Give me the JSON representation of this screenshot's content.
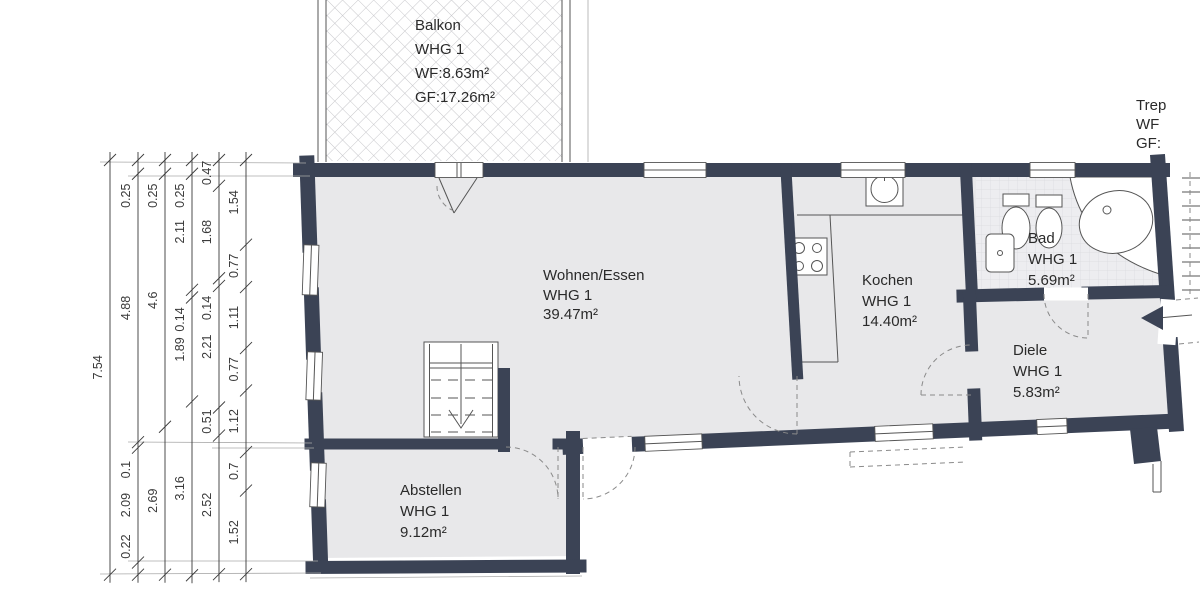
{
  "plan": {
    "balcony": {
      "name": "Balkon",
      "unit": "WHG 1",
      "wf": "WF:8.63m²",
      "gf": "GF:17.26m²"
    },
    "stairwell": {
      "name": "Trep",
      "wf": "WF",
      "gf": "GF:"
    },
    "rooms": {
      "wohnen": {
        "name": "Wohnen/Essen",
        "unit": "WHG 1",
        "area": "39.47m²"
      },
      "kochen": {
        "name": "Kochen",
        "unit": "WHG 1",
        "area": "14.40m²"
      },
      "bad": {
        "name": "Bad",
        "unit": "WHG 1",
        "area": "5.69m²"
      },
      "diele": {
        "name": "Diele",
        "unit": "WHG 1",
        "area": "5.83m²"
      },
      "abstellen": {
        "name": "Abstellen",
        "unit": "WHG 1",
        "area": "9.12m²"
      }
    }
  },
  "dimensions": {
    "unit": "m",
    "scale_px_per_m": 55,
    "top_y": 160,
    "chains": [
      {
        "x": 110,
        "values": [
          7.54
        ]
      },
      {
        "x": 138,
        "values": [
          0.25,
          4.88,
          0.1,
          2.09,
          0.22
        ]
      },
      {
        "x": 165,
        "values": [
          0.25,
          4.6,
          2.69
        ]
      },
      {
        "x": 192,
        "values": [
          0.25,
          2.11,
          0.14,
          1.89,
          3.16
        ]
      },
      {
        "x": 219,
        "values": [
          0.47,
          1.68,
          0.14,
          2.21,
          0.51,
          2.52
        ]
      },
      {
        "x": 246,
        "values": [
          1.54,
          0.77,
          1.11,
          0.77,
          1.12,
          0.7,
          1.52
        ]
      }
    ]
  },
  "colors": {
    "wall": "#3b4355",
    "floor": "#e8e8ea",
    "bathtile": "#ededf0",
    "hatch": "#c6c6ca",
    "line": "#555555",
    "dash": "#8a8a8a",
    "dim": "#3a3a3a",
    "text": "#2a2a2a"
  }
}
